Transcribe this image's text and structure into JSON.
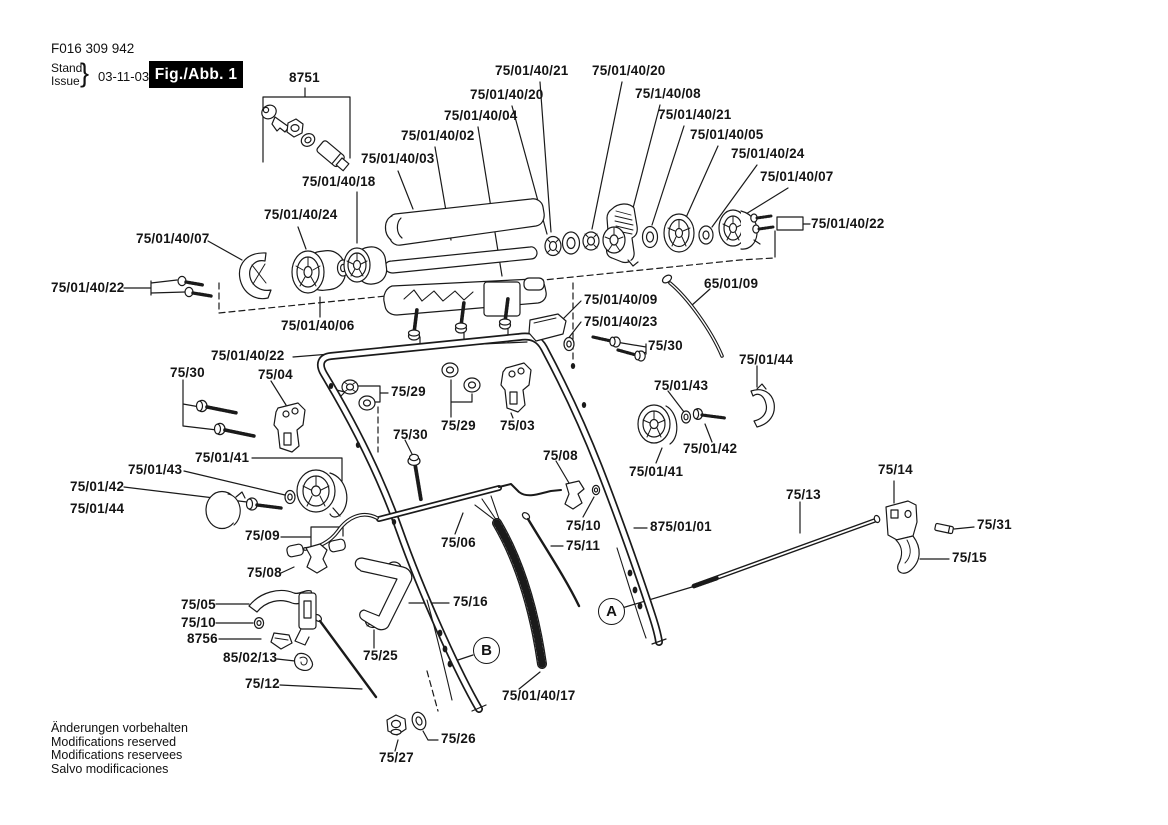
{
  "colors": {
    "ink": "#1a1a1a",
    "background": "#ffffff",
    "figure_box_bg": "#000000",
    "figure_box_text": "#ffffff"
  },
  "header": {
    "document_number": "F016 309 942",
    "stand_label": "Stand",
    "issue_label": "Issue",
    "brace": "}",
    "date": "03-11-03",
    "figure_label": "Fig./Abb. 1"
  },
  "figure": {
    "callouts": [
      {
        "text": "8751",
        "x": 289,
        "y": 71
      },
      {
        "text": "75/01/40/21",
        "x": 495,
        "y": 64
      },
      {
        "text": "75/01/40/20",
        "x": 592,
        "y": 64
      },
      {
        "text": "75/01/40/20",
        "x": 470,
        "y": 88
      },
      {
        "text": "75/1/40/08",
        "x": 635,
        "y": 87
      },
      {
        "text": "75/01/40/04",
        "x": 444,
        "y": 109
      },
      {
        "text": "75/01/40/21",
        "x": 658,
        "y": 108
      },
      {
        "text": "75/01/40/02",
        "x": 401,
        "y": 129
      },
      {
        "text": "75/01/40/05",
        "x": 690,
        "y": 128
      },
      {
        "text": "75/01/40/03",
        "x": 361,
        "y": 152
      },
      {
        "text": "75/01/40/24",
        "x": 731,
        "y": 147
      },
      {
        "text": "75/01/40/18",
        "x": 302,
        "y": 175
      },
      {
        "text": "75/01/40/07",
        "x": 760,
        "y": 170
      },
      {
        "text": "75/01/40/24",
        "x": 264,
        "y": 208
      },
      {
        "text": "75/01/40/07",
        "x": 136,
        "y": 232
      },
      {
        "text": "75/01/40/22",
        "x": 811,
        "y": 217
      },
      {
        "text": "75/01/40/22",
        "x": 51,
        "y": 281
      },
      {
        "text": "65/01/09",
        "x": 704,
        "y": 277
      },
      {
        "text": "75/01/40/09",
        "x": 584,
        "y": 293
      },
      {
        "text": "75/01/40/23",
        "x": 584,
        "y": 315
      },
      {
        "text": "75/01/40/06",
        "x": 281,
        "y": 319
      },
      {
        "text": "75/30",
        "x": 648,
        "y": 339
      },
      {
        "text": "75/01/40/22",
        "x": 211,
        "y": 349
      },
      {
        "text": "75/01/44",
        "x": 739,
        "y": 353
      },
      {
        "text": "75/30",
        "x": 170,
        "y": 366
      },
      {
        "text": "75/04",
        "x": 258,
        "y": 368
      },
      {
        "text": "75/01/43",
        "x": 654,
        "y": 379
      },
      {
        "text": "75/29",
        "x": 391,
        "y": 385
      },
      {
        "text": "75/29",
        "x": 441,
        "y": 419
      },
      {
        "text": "75/03",
        "x": 500,
        "y": 419
      },
      {
        "text": "75/30",
        "x": 393,
        "y": 428
      },
      {
        "text": "75/01/42",
        "x": 683,
        "y": 442
      },
      {
        "text": "75/08",
        "x": 543,
        "y": 449
      },
      {
        "text": "75/01/41",
        "x": 195,
        "y": 451
      },
      {
        "text": "75/14",
        "x": 878,
        "y": 463
      },
      {
        "text": "75/01/43",
        "x": 128,
        "y": 463
      },
      {
        "text": "75/01/41",
        "x": 629,
        "y": 465
      },
      {
        "text": "75/01/42",
        "x": 70,
        "y": 480
      },
      {
        "text": "75/13",
        "x": 786,
        "y": 488
      },
      {
        "text": "75/01/44",
        "x": 70,
        "y": 502
      },
      {
        "text": "75/31",
        "x": 977,
        "y": 518
      },
      {
        "text": "75/10",
        "x": 566,
        "y": 519
      },
      {
        "text": "875/01/01",
        "x": 650,
        "y": 520
      },
      {
        "text": "75/09",
        "x": 245,
        "y": 529
      },
      {
        "text": "75/06",
        "x": 441,
        "y": 536
      },
      {
        "text": "75/11",
        "x": 566,
        "y": 539
      },
      {
        "text": "75/15",
        "x": 952,
        "y": 551
      },
      {
        "text": "75/08",
        "x": 247,
        "y": 566
      },
      {
        "text": "75/16",
        "x": 453,
        "y": 595
      },
      {
        "text": "75/05",
        "x": 181,
        "y": 598
      },
      {
        "text": "75/10",
        "x": 181,
        "y": 616
      },
      {
        "text": "8756",
        "x": 187,
        "y": 632
      },
      {
        "text": "75/25",
        "x": 363,
        "y": 649
      },
      {
        "text": "85/02/13",
        "x": 223,
        "y": 651
      },
      {
        "text": "75/12",
        "x": 245,
        "y": 677
      },
      {
        "text": "75/01/40/17",
        "x": 502,
        "y": 689
      },
      {
        "text": "75/26",
        "x": 441,
        "y": 732
      },
      {
        "text": "75/27",
        "x": 379,
        "y": 751
      }
    ],
    "markers": [
      {
        "text": "A",
        "x": 612,
        "y": 612
      },
      {
        "text": "B",
        "x": 487,
        "y": 651
      }
    ]
  },
  "footer": {
    "lines": [
      "Änderungen vorbehalten",
      "Modifications reserved",
      "Modifications reservees",
      "Salvo modificaciones"
    ]
  }
}
